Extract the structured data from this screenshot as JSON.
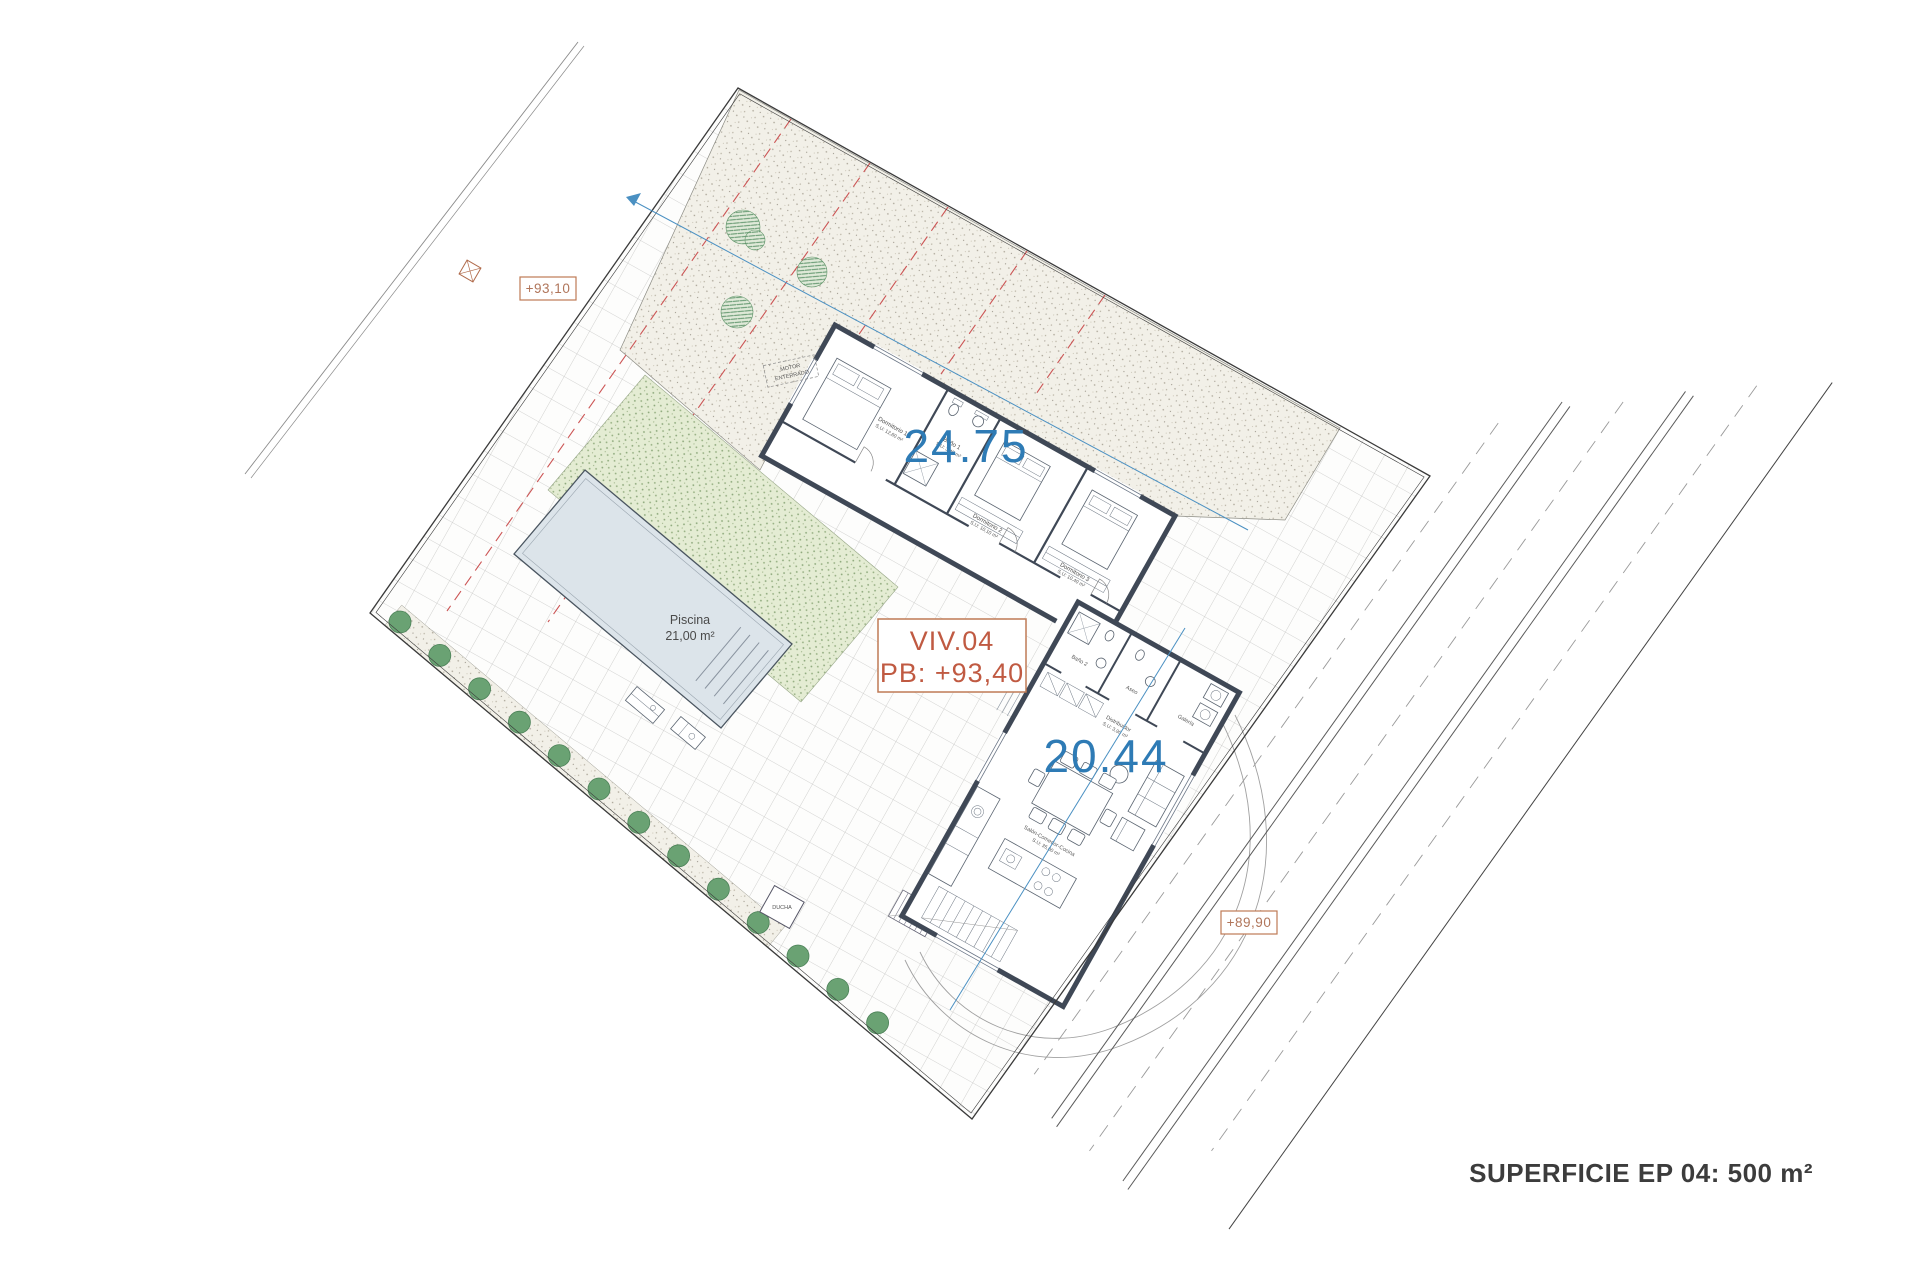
{
  "title": {
    "text": "SUPERFICIE EP 04: 500 m²"
  },
  "plan": {
    "area_labels": {
      "upper": "24.75",
      "lower": "20.44"
    },
    "unit_box": {
      "line1": "VIV.04",
      "line2": "PB: +93,40"
    },
    "levels": {
      "top": "+93,10",
      "bottom": "+89,90"
    },
    "pool": {
      "name": "Piscina",
      "area": "21,00 m²"
    },
    "motor": {
      "line1": "MOTOR",
      "line2": "ENTERRADO"
    },
    "shower": {
      "label": "DUCHA"
    },
    "rooms": [
      {
        "name": "Dormitorio 1",
        "area": "S.U: 12,60 m²"
      },
      {
        "name": "Baño 1",
        "area": "S.U: 3,45 m²"
      },
      {
        "name": "Dormitorio 2",
        "area": "S.U: 10,10 m²"
      },
      {
        "name": "Dormitorio 3",
        "area": "S.U: 10,40 m²"
      },
      {
        "name": "Baño 2",
        "area": "S.U: 3,80 m²"
      },
      {
        "name": "Aseo",
        "area": "S.U: 2,50 m²"
      },
      {
        "name": "Galería",
        "area": "S.U: 4,50 m²"
      },
      {
        "name": "Distribuidor",
        "area": "S.U: 3,90 m²"
      },
      {
        "name": "Salón-Comedor-Cocina",
        "area": "S.U: 35,00 m²"
      }
    ],
    "colors": {
      "accent_blue": "#2e7bb5",
      "rust": "#c05a42",
      "box_border": "#bf7a55",
      "level_text": "#b0755a",
      "red_dash": "#cc5555",
      "wall": "#3f4856",
      "pool_fill": "#dce4ea",
      "tree": "#6aa273",
      "blue_line": "#4a90c2"
    }
  }
}
